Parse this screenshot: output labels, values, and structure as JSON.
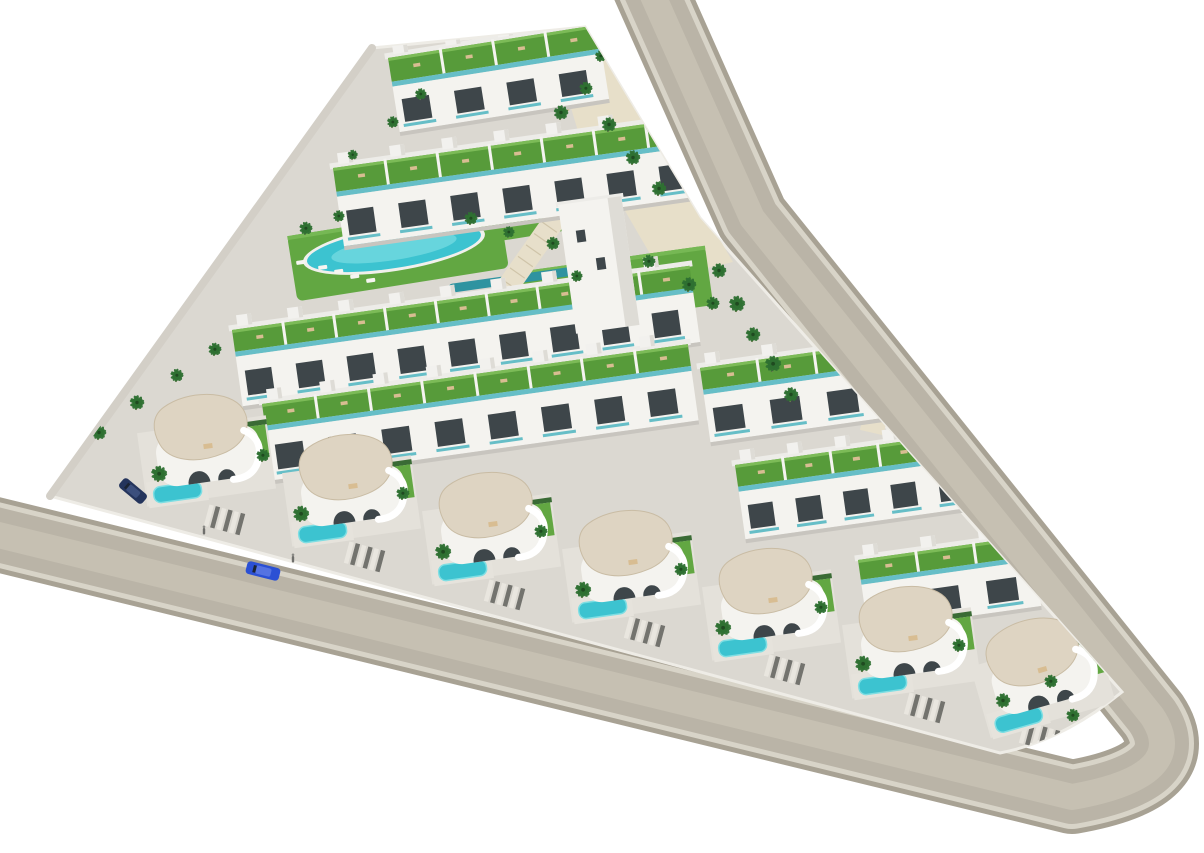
{
  "meta": {
    "alt": "Aerial 3D architectural rendering of a triangular residential development with white apartment rows with green roof terraces, curved white villas with cream roofs, swimming pools, palm trees and perimeter roads",
    "render_type": "architectural-masterplan-render"
  },
  "palette": {
    "bg": "#ffffff",
    "roadOuter": "#a8a294",
    "curb": "#d8d4c8",
    "asphalt": "#bab4a7",
    "roadWear": "#c6c0b2",
    "pavement": "#dbd8d1",
    "pavementLight": "#e4e1da",
    "sand": "#e7dfc9",
    "lawn": "#62a742",
    "lawnLight": "#76b854",
    "roofGreen": "#579b3a",
    "roofGreenLight": "#7cbb57",
    "pool": "#3cc3d0",
    "poolLight": "#7edee3",
    "poolRim": "#f1f0ec",
    "lapPool": "#2e93a0",
    "building": "#f4f3ef",
    "buildingShade": "#dedcd6",
    "parapet": "#edece8",
    "window": "#3e464a",
    "tealGlass": "#66bec7",
    "roofCream": "#ded4c2",
    "creamEdge": "#c9bca4",
    "hedge": "#3a6b35",
    "palm": "#2e7031",
    "palmDark": "#1f4a20",
    "trunk": "#93815f",
    "rampBeige": "#e7dfca",
    "rampStep": "#cfc4a9",
    "stripeDark": "#73736e",
    "stripeLight": "#e9e6df",
    "carBlue": "#2b50d4",
    "carBlueTop": "#5573e2",
    "carDark": "#24345c",
    "carDarkTop": "#3c4f7d",
    "figure": "#6f6f6c",
    "shadow": "#c8c5bf",
    "wall": "#d3cfc7",
    "tan": "#d8bd92",
    "deck": "#e6e3dc"
  },
  "scene": {
    "canvas": {
      "w": 1204,
      "h": 853
    },
    "roads": {
      "centerline": "M 646,-20 L 752,218 L 1152,716 Q 1192,776 1072,797 L -30,528",
      "layers": [
        {
          "w": 74,
          "c": "roadOuter"
        },
        {
          "w": 64,
          "c": "curb"
        },
        {
          "w": 54,
          "c": "asphalt"
        },
        {
          "w": 26,
          "c": "roadWear"
        }
      ]
    },
    "plot": "M 372,48 L 585,27 L 700,218 L 1122,692 Q 1062,741 1000,753 L 50,496 Z",
    "leftWall": "M 50,496 L 372,48",
    "sand": "M 556,58 L 598,34 L 733,262 L 664,278 L 577,128 Z",
    "lawns": [
      {
        "cx": 398,
        "cy": 252,
        "w": 214,
        "h": 66,
        "rot": -9
      },
      {
        "cx": 612,
        "cy": 289,
        "w": 196,
        "h": 60,
        "rot": -8
      },
      {
        "cx": 505,
        "cy": 225,
        "w": 120,
        "h": 30,
        "rot": -9
      }
    ],
    "lapPool": {
      "cx": 524,
      "cy": 278,
      "w": 152,
      "h": 9,
      "rot": -8
    },
    "pools": [
      {
        "cx": 394,
        "cy": 248,
        "rx": 88,
        "ry": 20,
        "rot": -9,
        "name": "main-oval-pool"
      },
      {
        "cx": 633,
        "cy": 290,
        "rx": 28,
        "ry": 12,
        "rot": -8,
        "name": "round-pool"
      }
    ],
    "props": [
      {
        "x": 296,
        "y": 261
      },
      {
        "x": 318,
        "y": 266
      },
      {
        "x": 334,
        "y": 270
      },
      {
        "x": 350,
        "y": 275
      },
      {
        "x": 366,
        "y": 279
      },
      {
        "x": 604,
        "y": 300
      },
      {
        "x": 620,
        "y": 304
      },
      {
        "x": 560,
        "y": 108,
        "c": "tan"
      },
      {
        "x": 598,
        "y": 126,
        "c": "tan"
      },
      {
        "x": 622,
        "y": 152,
        "c": "tan"
      },
      {
        "x": 660,
        "y": 298,
        "w": 16,
        "h": 10,
        "c": "deck"
      }
    ],
    "ramps": [
      {
        "cx": 530,
        "cy": 255,
        "w": 22,
        "h": 112,
        "rot": 35
      },
      {
        "cx": 893,
        "cy": 340,
        "w": 24,
        "h": 190,
        "rot": 13
      }
    ],
    "bands": [
      {
        "x": 388,
        "y": 58,
        "w": 212,
        "seg": 4,
        "roofH": 24,
        "frontH": 46,
        "rot": -9,
        "name": "apartment-row-1"
      },
      {
        "x": 333,
        "y": 168,
        "w": 368,
        "seg": 7,
        "roofH": 24,
        "frontH": 50,
        "rot": -8,
        "name": "apartment-row-2"
      },
      {
        "x": 232,
        "y": 330,
        "w": 462,
        "seg": 9,
        "roofH": 22,
        "frontH": 50,
        "rot": -8,
        "name": "townhouse-row-3"
      },
      {
        "x": 262,
        "y": 404,
        "w": 430,
        "seg": 8,
        "roofH": 22,
        "frontH": 50,
        "rot": -8,
        "name": "townhouse-row-4"
      },
      {
        "x": 700,
        "y": 368,
        "w": 230,
        "seg": 4,
        "roofH": 22,
        "frontH": 48,
        "rot": -8,
        "name": "townhouse-row-4r"
      },
      {
        "x": 735,
        "y": 465,
        "w": 240,
        "seg": 5,
        "roofH": 22,
        "frontH": 48,
        "rot": -8,
        "name": "townhouse-row-5r"
      },
      {
        "x": 858,
        "y": 560,
        "w": 175,
        "seg": 3,
        "roofH": 20,
        "frontH": 46,
        "rot": -8,
        "name": "townhouse-row-6r"
      }
    ],
    "tower": {
      "x": 558,
      "y": 205,
      "w": 64,
      "h": 130,
      "rot": -8
    },
    "driveways": [
      {
        "cx": 225,
        "cy": 520
      },
      {
        "cx": 365,
        "cy": 557
      },
      {
        "cx": 505,
        "cy": 595
      },
      {
        "cx": 645,
        "cy": 632
      },
      {
        "cx": 785,
        "cy": 670
      },
      {
        "cx": 925,
        "cy": 708
      },
      {
        "cx": 1040,
        "cy": 737
      }
    ],
    "villas": [
      {
        "x": 140,
        "y": 398,
        "rot": -8
      },
      {
        "x": 285,
        "y": 438,
        "rot": -8
      },
      {
        "x": 425,
        "y": 476,
        "rot": -8
      },
      {
        "x": 565,
        "y": 514,
        "rot": -8
      },
      {
        "x": 705,
        "y": 552,
        "rot": -8
      },
      {
        "x": 845,
        "y": 590,
        "rot": -8
      },
      {
        "x": 975,
        "y": 622,
        "rot": -16
      }
    ],
    "palms": [
      [
        62,
        470,
        1.1
      ],
      [
        98,
        440,
        1
      ],
      [
        136,
        410,
        1
      ],
      [
        176,
        382,
        0.9
      ],
      [
        214,
        356,
        0.9
      ],
      [
        305,
        235,
        0.9
      ],
      [
        338,
        222,
        0.8
      ],
      [
        470,
        225,
        0.9
      ],
      [
        508,
        238,
        0.8
      ],
      [
        552,
        250,
        0.9
      ],
      [
        576,
        282,
        0.8
      ],
      [
        648,
        268,
        0.9
      ],
      [
        688,
        292,
        1
      ],
      [
        712,
        310,
        0.9
      ],
      [
        560,
        120,
        1
      ],
      [
        585,
        95,
        0.9
      ],
      [
        608,
        132,
        1
      ],
      [
        632,
        165,
        1
      ],
      [
        658,
        196,
        1
      ],
      [
        600,
        62,
        0.8
      ],
      [
        718,
        278,
        1
      ],
      [
        736,
        312,
        1.1
      ],
      [
        752,
        342,
        1
      ],
      [
        772,
        372,
        1.1
      ],
      [
        790,
        402,
        1
      ],
      [
        158,
        482,
        1.1
      ],
      [
        262,
        462,
        0.9
      ],
      [
        300,
        522,
        1.1
      ],
      [
        402,
        500,
        0.9
      ],
      [
        442,
        560,
        1.1
      ],
      [
        540,
        538,
        0.9
      ],
      [
        582,
        598,
        1.1
      ],
      [
        680,
        576,
        0.9
      ],
      [
        722,
        636,
        1.1
      ],
      [
        820,
        614,
        0.9
      ],
      [
        862,
        672,
        1.1
      ],
      [
        958,
        652,
        0.9
      ],
      [
        1002,
        708,
        1
      ],
      [
        1050,
        688,
        0.9
      ],
      [
        1072,
        722,
        0.9
      ],
      [
        392,
        128,
        0.8
      ],
      [
        420,
        100,
        0.8
      ],
      [
        352,
        160,
        0.7
      ]
    ],
    "cars": [
      {
        "cx": 263,
        "cy": 571,
        "l": 34,
        "w": 13,
        "rot": 14,
        "body": "carBlue",
        "top": "carBlueTop",
        "name": "car-blue-driving"
      },
      {
        "cx": 133,
        "cy": 491,
        "l": 30,
        "w": 12,
        "rot": 40,
        "body": "carDark",
        "top": "carDarkTop",
        "name": "car-dark-parked"
      }
    ],
    "people": [
      {
        "x": 204,
        "y": 531
      },
      {
        "x": 293,
        "y": 559
      }
    ]
  }
}
